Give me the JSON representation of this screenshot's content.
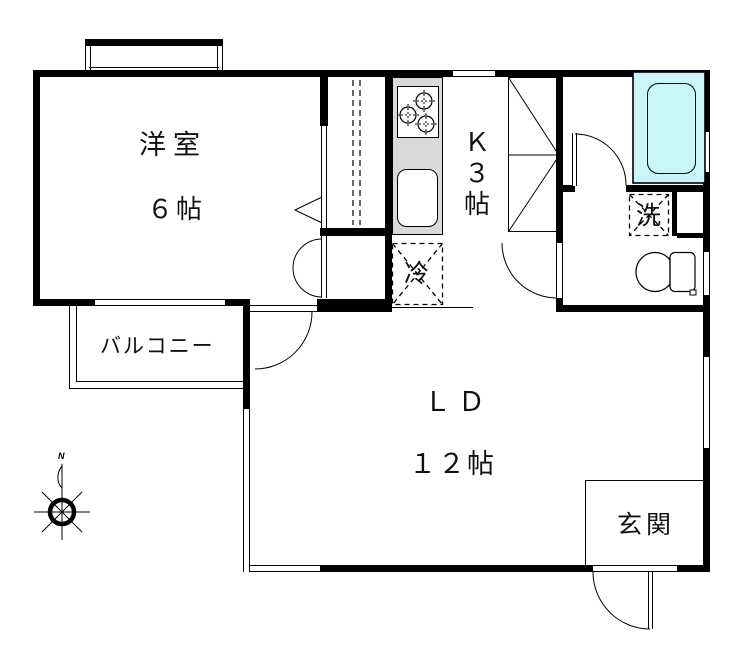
{
  "floorplan": {
    "rooms": {
      "western_room": {
        "name": "洋室",
        "size": "６帖"
      },
      "kitchen": {
        "label": "Ｋ\n３\n帖"
      },
      "living_dining": {
        "name": "ＬＤ",
        "size": "１２帖"
      },
      "balcony": {
        "name": "バルコニー"
      },
      "entrance": {
        "name": "玄関"
      }
    },
    "fixtures": {
      "washing_machine_label": "洗",
      "refrigerator_label": "冷"
    },
    "compass": {
      "north": "N"
    },
    "colors": {
      "wall": "#000000",
      "bathtub_fill": "#c9f6f6",
      "kitchen_counter": "#d9d9d9",
      "background": "#ffffff"
    }
  }
}
